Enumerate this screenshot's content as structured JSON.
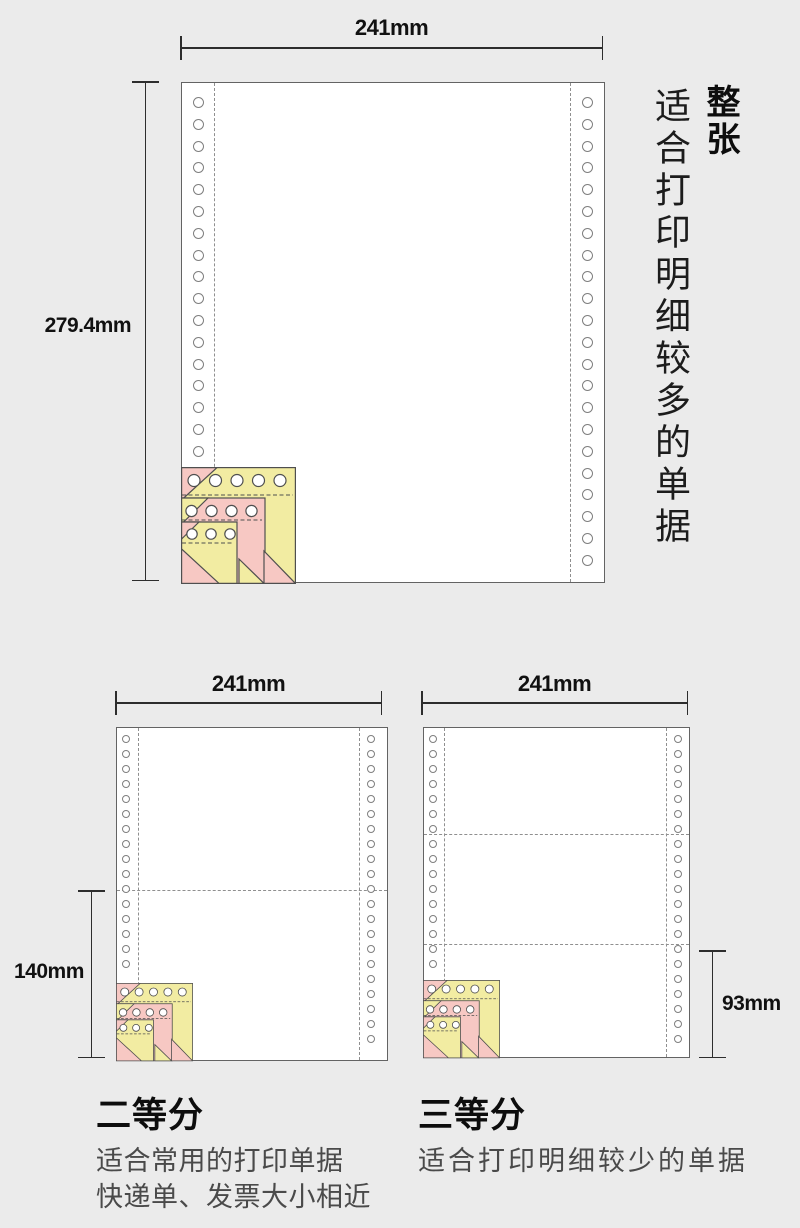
{
  "page": {
    "background": "#ebebeb"
  },
  "ply_colors": {
    "yellow": "#f2eca2",
    "pink": "#f7c8c3"
  },
  "full_sheet": {
    "width_label": "241mm",
    "height_label": "279.4mm",
    "title": "整张",
    "description": "适合打印明细较多的单据"
  },
  "half_sheet": {
    "width_label": "241mm",
    "height_label": "140mm",
    "title": "二等分",
    "description_line1": "适合常用的打印单据",
    "description_line2": "快递单、发票大小相近"
  },
  "third_sheet": {
    "width_label": "241mm",
    "height_label": "93mm",
    "title": "三等分",
    "description_line1": "适合打印明细较少的单据"
  }
}
